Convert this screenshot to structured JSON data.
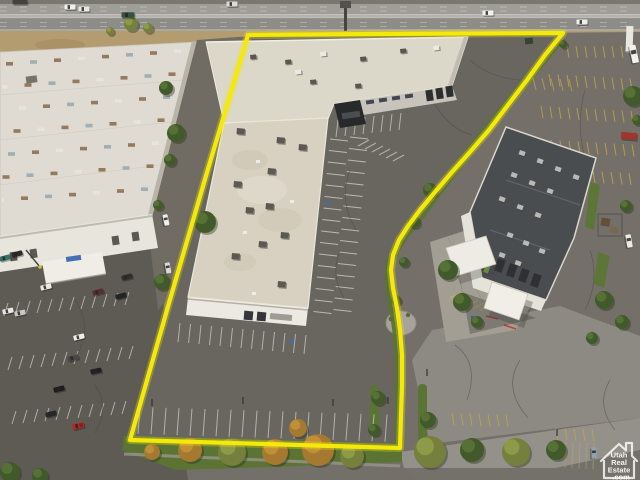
{
  "watermark": {
    "icon": "house-icon",
    "lines": [
      "Utah",
      "Real",
      "Estate",
      ".com"
    ]
  },
  "colors": {
    "boundary_yellow": "#F5E90A",
    "stall_white": "#FFFFFF",
    "stall_yellow": "#C9A23E",
    "grass_green": "#55702E",
    "asphalt_dark": "#585650",
    "asphalt_mid": "#6F6C66",
    "concrete_light": "#918F88",
    "roof_white": "#DCD8CB",
    "roof_beige": "#D8D2C3",
    "roof_dark": "#43474B",
    "accent_green": "#6FAE3F",
    "dirt_tan": "#B29A6C",
    "watermark_white": "#FFFFFF"
  },
  "boundary": {
    "points": "248,35 380,34 563,33 545,55 527,80 508,105 489,130 470,152 452,172 435,192 420,210 408,226 399,240 393,255 391,270 393,288 397,308 400,330 402,355 402,385 401,415 400,448 265,444 130,440 169,303 208,169"
  },
  "scene": {
    "vehicles": [
      {
        "x": 20,
        "y": 2,
        "a": 0,
        "c": "#3B3B39",
        "k": "semi"
      },
      {
        "x": 70,
        "y": 7,
        "a": 0,
        "c": "#F3F3EF",
        "k": "car"
      },
      {
        "x": 84,
        "y": 9,
        "a": 0,
        "c": "#E9E9E5",
        "k": "car"
      },
      {
        "x": 128,
        "y": 15,
        "a": 0,
        "c": "#2F4B41",
        "k": "van"
      },
      {
        "x": 232,
        "y": 4,
        "a": 0,
        "c": "#DCDCD6",
        "k": "car"
      },
      {
        "x": 488,
        "y": 13,
        "a": 0,
        "c": "#F5F5F1",
        "k": "car"
      },
      {
        "x": 582,
        "y": 22,
        "a": 0,
        "c": "#F2F2EE",
        "k": "car"
      },
      {
        "x": 5,
        "y": 258,
        "a": -15,
        "c": "#2F6F60",
        "k": "car"
      },
      {
        "x": 17,
        "y": 254,
        "a": -15,
        "c": "#202423",
        "k": "car"
      },
      {
        "x": 46,
        "y": 287,
        "a": -14,
        "c": "#EDEBE7",
        "k": "car"
      },
      {
        "x": 8,
        "y": 311,
        "a": -12,
        "c": "#EAE9E5",
        "k": "car"
      },
      {
        "x": 20,
        "y": 313,
        "a": -12,
        "c": "#C8C8C4",
        "k": "car"
      },
      {
        "x": 98,
        "y": 292,
        "a": -15,
        "c": "#54262A",
        "k": "car"
      },
      {
        "x": 121,
        "y": 296,
        "a": -15,
        "c": "#1A1C1E",
        "k": "car"
      },
      {
        "x": 127,
        "y": 277,
        "a": -15,
        "c": "#26282A",
        "k": "car"
      },
      {
        "x": 79,
        "y": 337,
        "a": -14,
        "c": "#F0EFEB",
        "k": "car"
      },
      {
        "x": 73,
        "y": 358,
        "a": -14,
        "c": "#404245",
        "k": "car"
      },
      {
        "x": 96,
        "y": 371,
        "a": -12,
        "c": "#17191B",
        "k": "car"
      },
      {
        "x": 59,
        "y": 389,
        "a": -14,
        "c": "#131517",
        "k": "car"
      },
      {
        "x": 51,
        "y": 414,
        "a": -14,
        "c": "#1D1F21",
        "k": "car"
      },
      {
        "x": 78,
        "y": 426,
        "a": -14,
        "c": "#B3241E",
        "k": "pickup"
      },
      {
        "x": 166,
        "y": 220,
        "a": 78,
        "c": "#F2F1ED",
        "k": "car"
      },
      {
        "x": 168,
        "y": 268,
        "a": 80,
        "c": "#DDDCD8",
        "k": "car"
      },
      {
        "x": 594,
        "y": 453,
        "a": 88,
        "c": "#8BA2AE",
        "k": "car"
      },
      {
        "x": 629,
        "y": 241,
        "a": 80,
        "c": "#EDECE7",
        "k": "van"
      },
      {
        "x": 634,
        "y": 54,
        "a": 78,
        "c": "#F5F4F0",
        "k": "rv"
      },
      {
        "x": 629,
        "y": 136,
        "a": 5,
        "c": "#9C2F24",
        "k": "container"
      }
    ],
    "tree_palette": {
      "green": [
        "#3A5524",
        "#527031"
      ],
      "olive": [
        "#6F7D35",
        "#8D9C45"
      ],
      "autumn": [
        "#A3762A",
        "#C29134"
      ]
    },
    "trees": [
      {
        "x": 131,
        "y": 24,
        "r": 7,
        "t": "olive"
      },
      {
        "x": 148,
        "y": 28,
        "r": 5,
        "t": "olive"
      },
      {
        "x": 110,
        "y": 31,
        "r": 4,
        "t": "olive"
      },
      {
        "x": 563,
        "y": 44,
        "r": 4,
        "t": "green"
      },
      {
        "x": 166,
        "y": 88,
        "r": 7,
        "t": "green"
      },
      {
        "x": 176,
        "y": 133,
        "r": 9,
        "t": "green"
      },
      {
        "x": 170,
        "y": 160,
        "r": 6,
        "t": "green"
      },
      {
        "x": 158,
        "y": 205,
        "r": 5,
        "t": "green"
      },
      {
        "x": 205,
        "y": 222,
        "r": 11,
        "t": "green"
      },
      {
        "x": 162,
        "y": 282,
        "r": 8,
        "t": "green"
      },
      {
        "x": 10,
        "y": 472,
        "r": 10,
        "t": "green"
      },
      {
        "x": 40,
        "y": 476,
        "r": 8,
        "t": "green"
      },
      {
        "x": 152,
        "y": 452,
        "r": 8,
        "t": "autumn"
      },
      {
        "x": 190,
        "y": 450,
        "r": 12,
        "t": "autumn"
      },
      {
        "x": 232,
        "y": 452,
        "r": 14,
        "t": "olive"
      },
      {
        "x": 275,
        "y": 452,
        "r": 13,
        "t": "autumn"
      },
      {
        "x": 318,
        "y": 450,
        "r": 16,
        "t": "autumn"
      },
      {
        "x": 352,
        "y": 456,
        "r": 12,
        "t": "olive"
      },
      {
        "x": 298,
        "y": 428,
        "r": 9,
        "t": "autumn"
      },
      {
        "x": 430,
        "y": 452,
        "r": 16,
        "t": "olive"
      },
      {
        "x": 472,
        "y": 450,
        "r": 12,
        "t": "green"
      },
      {
        "x": 516,
        "y": 452,
        "r": 14,
        "t": "olive"
      },
      {
        "x": 556,
        "y": 450,
        "r": 10,
        "t": "green"
      },
      {
        "x": 430,
        "y": 190,
        "r": 7,
        "t": "green"
      },
      {
        "x": 414,
        "y": 222,
        "r": 6,
        "t": "green"
      },
      {
        "x": 404,
        "y": 262,
        "r": 5,
        "t": "green"
      },
      {
        "x": 396,
        "y": 300,
        "r": 5,
        "t": "green"
      },
      {
        "x": 378,
        "y": 398,
        "r": 7,
        "t": "green"
      },
      {
        "x": 428,
        "y": 420,
        "r": 8,
        "t": "green"
      },
      {
        "x": 374,
        "y": 430,
        "r": 6,
        "t": "green"
      },
      {
        "x": 448,
        "y": 270,
        "r": 10,
        "t": "green"
      },
      {
        "x": 462,
        "y": 302,
        "r": 9,
        "t": "green"
      },
      {
        "x": 477,
        "y": 322,
        "r": 6,
        "t": "green"
      },
      {
        "x": 604,
        "y": 300,
        "r": 9,
        "t": "green"
      },
      {
        "x": 622,
        "y": 322,
        "r": 7,
        "t": "green"
      },
      {
        "x": 592,
        "y": 338,
        "r": 6,
        "t": "green"
      },
      {
        "x": 633,
        "y": 96,
        "r": 10,
        "t": "green"
      },
      {
        "x": 626,
        "y": 206,
        "r": 6,
        "t": "green"
      },
      {
        "x": 637,
        "y": 120,
        "r": 5,
        "t": "green"
      }
    ],
    "hvac_south": [
      [
        237,
        128
      ],
      [
        277,
        137
      ],
      [
        299,
        144
      ],
      [
        268,
        168
      ],
      [
        234,
        181
      ],
      [
        246,
        207
      ],
      [
        266,
        203
      ],
      [
        281,
        232
      ],
      [
        259,
        241
      ],
      [
        232,
        253
      ],
      [
        278,
        281
      ]
    ],
    "vents_south": [
      [
        256,
        160
      ],
      [
        243,
        231
      ],
      [
        290,
        200
      ],
      [
        252,
        292
      ]
    ],
    "hvac_north": [
      [
        250,
        55
      ],
      [
        285,
        60
      ],
      [
        320,
        52
      ],
      [
        360,
        57
      ],
      [
        400,
        49
      ],
      [
        433,
        46
      ],
      [
        310,
        80
      ],
      [
        355,
        84
      ],
      [
        295,
        70
      ]
    ],
    "hvac_right": [
      [
        520,
        150
      ],
      [
        538,
        158
      ],
      [
        556,
        166
      ],
      [
        574,
        174
      ],
      [
        512,
        172
      ],
      [
        530,
        180
      ],
      [
        548,
        188
      ],
      [
        500,
        196
      ],
      [
        518,
        204
      ],
      [
        536,
        212
      ],
      [
        508,
        232
      ],
      [
        524,
        240
      ],
      [
        540,
        248
      ],
      [
        500,
        252
      ],
      [
        516,
        260
      ]
    ],
    "stall_rows": [
      {
        "x": 4,
        "y": 247,
        "sx": 11,
        "sy": -1,
        "n": 12,
        "dx": -4,
        "dy": 13,
        "c": "#FFFFFF",
        "o": 0.5
      },
      {
        "x": 8,
        "y": 303,
        "sx": 11,
        "sy": -1,
        "n": 12,
        "dx": -4,
        "dy": 13,
        "c": "#FFFFFF",
        "o": 0.5
      },
      {
        "x": 12,
        "y": 357,
        "sx": 11,
        "sy": -1,
        "n": 12,
        "dx": -4,
        "dy": 13,
        "c": "#FFFFFF",
        "o": 0.5
      },
      {
        "x": 16,
        "y": 411,
        "sx": 11,
        "sy": -1,
        "n": 11,
        "dx": -4,
        "dy": 13,
        "c": "#FFFFFF",
        "o": 0.5
      },
      {
        "x": 330,
        "y": 139,
        "sx": -1.1,
        "sy": 11.5,
        "n": 16,
        "dx": 18,
        "dy": 2,
        "c": "#FFFFFF",
        "o": 0.55
      },
      {
        "x": 350,
        "y": 137,
        "sx": -1.1,
        "sy": 11.5,
        "n": 16,
        "dx": 18,
        "dy": 2,
        "c": "#FFFFFF",
        "o": 0.55
      },
      {
        "x": 140,
        "y": 407,
        "sx": 13,
        "sy": 0.4,
        "n": 20,
        "dx": -2,
        "dy": 27,
        "c": "#FFFFFF",
        "o": 0.5
      },
      {
        "x": 180,
        "y": 323,
        "sx": 10.5,
        "sy": 1,
        "n": 13,
        "dx": -2,
        "dy": 19,
        "c": "#FFFFFF",
        "o": 0.5
      },
      {
        "x": 338,
        "y": 120,
        "sx": 9,
        "sy": -1,
        "n": 8,
        "dx": -2,
        "dy": 17,
        "c": "#FFFFFF",
        "o": 0.5
      },
      {
        "x": 567,
        "y": 46,
        "sx": 9,
        "sy": 0,
        "n": 8,
        "dx": 2,
        "dy": 12,
        "c": "#C9A23E",
        "o": 0.8
      },
      {
        "x": 549,
        "y": 74,
        "sx": 9,
        "sy": 0.5,
        "n": 10,
        "dx": 2,
        "dy": 12,
        "c": "#C9A23E",
        "o": 0.8
      },
      {
        "x": 541,
        "y": 106,
        "sx": 9,
        "sy": 0.5,
        "n": 11,
        "dx": 2,
        "dy": 12,
        "c": "#C9A23E",
        "o": 0.8
      },
      {
        "x": 533,
        "y": 139,
        "sx": 9,
        "sy": 0.5,
        "n": 12,
        "dx": 2,
        "dy": 12,
        "c": "#C9A23E",
        "o": 0.8
      },
      {
        "x": 575,
        "y": 170,
        "sx": 9,
        "sy": 0.5,
        "n": 7,
        "dx": 2,
        "dy": 12,
        "c": "#C9A23E",
        "o": 0.8
      },
      {
        "x": 533,
        "y": 78,
        "sx": 9,
        "sy": 0.3,
        "n": 5,
        "dx": 3,
        "dy": 12,
        "c": "#C9A23E",
        "o": 0.7
      },
      {
        "x": 452,
        "y": 413,
        "sx": 9,
        "sy": 0.3,
        "n": 7,
        "dx": 2,
        "dy": 12,
        "c": "#C9A23E",
        "o": 0.8
      },
      {
        "x": 556,
        "y": 428,
        "sx": 9,
        "sy": 0.3,
        "n": 5,
        "dx": 2,
        "dy": 12,
        "c": "#C9A23E",
        "o": 0.8
      },
      {
        "x": 566,
        "y": 442,
        "sx": 7,
        "sy": 0.3,
        "n": 5,
        "dx": -1,
        "dy": 26,
        "c": "#B59E6D",
        "o": 0.6
      },
      {
        "x": 358,
        "y": 146,
        "sx": 7,
        "sy": 3,
        "n": 6,
        "dx": 11,
        "dy": -6,
        "c": "#FFFFFF",
        "o": 0.5
      },
      {
        "x": 450,
        "y": 298,
        "sx": 6,
        "sy": 2.5,
        "n": 6,
        "dx": 10,
        "dy": -5,
        "c": "#D9B44A",
        "o": 0.8
      }
    ],
    "skylights": {
      "x0": 6,
      "y0": 62,
      "cols": 8,
      "rows": 7,
      "stepX": 24,
      "stepY": 23,
      "shearX": 5.5,
      "shearY": -1.8,
      "w": 7,
      "h": 3.6,
      "colors": [
        "#8A6B4C",
        "#97A7B4",
        "#8A6B4C",
        "#E9E7E0"
      ]
    }
  }
}
